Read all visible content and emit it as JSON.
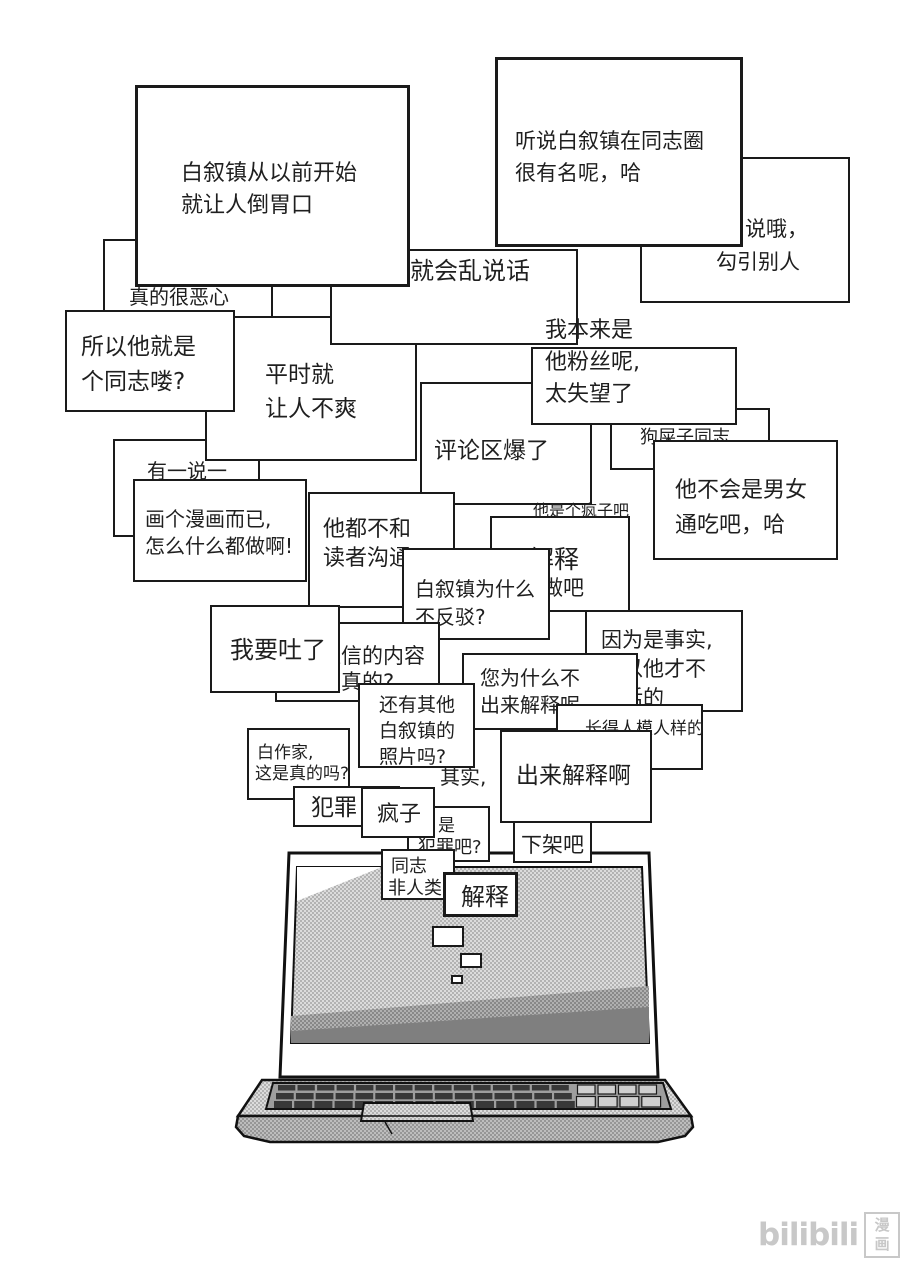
{
  "watermark": {
    "brand": "bilibili",
    "suffix": "漫画",
    "color": "#c8c8c8"
  },
  "palette": {
    "line": "#1a1a1a",
    "text": "#1f1f1f",
    "halftone_light": "#cccccc",
    "halftone_mid": "#a9a9a9",
    "wedge_dark": "#7f7f7f",
    "key_dark": "#383838",
    "key_light": "#cfcfcf"
  },
  "comments": [
    {
      "id": "comment-really-disgusting",
      "x": 103,
      "y": 239,
      "w": 170,
      "h": 92,
      "lines": [
        {
          "t": "真的很恶心",
          "dx": 24,
          "dy": 45,
          "s": 20
        }
      ]
    },
    {
      "id": "comment-to-be-fair",
      "x": 113,
      "y": 439,
      "w": 147,
      "h": 98,
      "lines": [
        {
          "t": "有一说一",
          "dx": 32,
          "dy": 19,
          "s": 20
        }
      ]
    },
    {
      "id": "comment-always-annoying",
      "x": 205,
      "y": 316,
      "w": 212,
      "h": 145,
      "lines": [
        {
          "t": "平时就",
          "dx": 58,
          "dy": 44,
          "s": 23
        },
        {
          "t": "让人不爽",
          "dx": 58,
          "dy": 78,
          "s": 23
        }
      ]
    },
    {
      "id": "comment-so-he-is-gay",
      "x": 65,
      "y": 310,
      "w": 170,
      "h": 102,
      "lines": [
        {
          "t": "所以他就是",
          "dx": 14,
          "dy": 22,
          "s": 23
        },
        {
          "t": "个同志喽?",
          "dx": 14,
          "dy": 57,
          "s": 23
        }
      ]
    },
    {
      "id": "comment-talks-nonsense",
      "x": 330,
      "y": 249,
      "w": 248,
      "h": 96,
      "lines": [
        {
          "t": "就会乱说话",
          "dx": 78,
          "dy": 7,
          "s": 24
        }
      ]
    },
    {
      "id": "comment-just-a-manga",
      "x": 133,
      "y": 479,
      "w": 174,
      "h": 103,
      "lines": [
        {
          "t": "画个漫画而已,",
          "dx": 10,
          "dy": 27,
          "s": 20
        },
        {
          "t": "怎么什么都做啊!",
          "dx": 10,
          "dy": 54,
          "s": 20
        }
      ]
    },
    {
      "id": "comment-disgusting-from-start",
      "x": 135,
      "y": 85,
      "w": 275,
      "h": 202,
      "bw": 3,
      "lines": [
        {
          "t": "白叙镇从以前开始",
          "dx": 43,
          "dy": 73,
          "s": 22
        },
        {
          "t": "就让人倒胃口",
          "dx": 43,
          "dy": 105,
          "s": 22
        }
      ]
    },
    {
      "id": "comment-seducing-others",
      "x": 640,
      "y": 157,
      "w": 210,
      "h": 146,
      "lines": [
        {
          "t": "说哦，",
          "dx": 103,
          "dy": 58,
          "s": 21
        },
        {
          "t": "勾引别人",
          "dx": 74,
          "dy": 91,
          "s": 21
        }
      ]
    },
    {
      "id": "comment-famous-in-gay-circle",
      "x": 495,
      "y": 57,
      "w": 248,
      "h": 190,
      "bw": 3,
      "lines": [
        {
          "t": "听说白叙镇在同志圈",
          "dx": 17,
          "dy": 69,
          "s": 21
        },
        {
          "t": "很有名呢，哈",
          "dx": 17,
          "dy": 101,
          "s": 21
        }
      ]
    },
    {
      "id": "comment-section-exploded",
      "x": 420,
      "y": 382,
      "w": 172,
      "h": 123,
      "lines": [
        {
          "t": "评论区爆了",
          "dx": 12,
          "dy": 54,
          "s": 23
        }
      ]
    },
    {
      "id": "comment-dogshit-comrade",
      "x": 610,
      "y": 408,
      "w": 160,
      "h": 62,
      "lines": [
        {
          "t": "狗屎子同志",
          "dx": 28,
          "dy": 18,
          "s": 18
        }
      ]
    },
    {
      "id": "comment-was-his-fan",
      "x": 531,
      "y": 347,
      "w": 206,
      "h": 78,
      "lines": [
        {
          "t": "我本来是",
          "dx": 12,
          "dy": -31,
          "s": 22
        },
        {
          "t": "他粉丝呢,",
          "dx": 12,
          "dy": 1,
          "s": 22
        },
        {
          "t": "太失望了",
          "dx": 12,
          "dy": 33,
          "s": 22
        }
      ]
    },
    {
      "id": "comment-swings-both-ways",
      "x": 653,
      "y": 440,
      "w": 185,
      "h": 120,
      "lines": [
        {
          "t": "他不会是男女",
          "dx": 20,
          "dy": 36,
          "s": 22
        },
        {
          "t": "通吃吧，哈",
          "dx": 20,
          "dy": 71,
          "s": 22
        }
      ]
    },
    {
      "id": "comment-never-talks-to-readers",
      "x": 308,
      "y": 492,
      "w": 147,
      "h": 116,
      "lines": [
        {
          "t": "他都不和",
          "dx": 13,
          "dy": 23,
          "s": 22
        },
        {
          "t": "读者沟通",
          "dx": 13,
          "dy": 52,
          "s": 22
        }
      ]
    },
    {
      "id": "comment-explain-do-it",
      "x": 490,
      "y": 516,
      "w": 140,
      "h": 96,
      "lines": [
        {
          "t": "解释",
          "dx": 37,
          "dy": 28,
          "s": 25
        },
        {
          "t": "做吧",
          "dx": 50,
          "dy": 58,
          "s": 21
        }
      ]
    },
    {
      "id": "comment-why-not-refute",
      "x": 402,
      "y": 548,
      "w": 148,
      "h": 92,
      "lines": [
        {
          "t": "白叙镇为什么",
          "dx": 11,
          "dy": 28,
          "s": 20
        },
        {
          "t": "不反驳?",
          "dx": 11,
          "dy": 56,
          "s": 20
        }
      ]
    },
    {
      "id": "comment-are-texts-real",
      "x": 275,
      "y": 622,
      "w": 165,
      "h": 80,
      "lines": [
        {
          "t": "短信的内容",
          "dx": 43,
          "dy": 20,
          "s": 21
        },
        {
          "t": "是真的?",
          "dx": 43,
          "dy": 46,
          "s": 21
        }
      ]
    },
    {
      "id": "comment-gonna-puke",
      "x": 210,
      "y": 605,
      "w": 130,
      "h": 88,
      "lines": [
        {
          "t": "我要吐了",
          "dx": 18,
          "dy": 30,
          "s": 24
        }
      ]
    },
    {
      "id": "comment-because-its-true",
      "x": 585,
      "y": 610,
      "w": 158,
      "h": 102,
      "lines": [
        {
          "t": "因为是事实,",
          "dx": 14,
          "dy": 16,
          "s": 21
        },
        {
          "t": "所以他才不",
          "dx": 14,
          "dy": 45,
          "s": 21
        },
        {
          "t": "说话的",
          "dx": 14,
          "dy": 74,
          "s": 21
        }
      ]
    },
    {
      "id": "comment-why-no-explanation",
      "x": 462,
      "y": 653,
      "w": 176,
      "h": 77,
      "lines": [
        {
          "t": "您为什么不",
          "dx": 16,
          "dy": 12,
          "s": 20
        },
        {
          "t": "出来解释呢",
          "dx": 16,
          "dy": 39,
          "s": 20
        }
      ]
    },
    {
      "id": "comment-looks-decent",
      "x": 556,
      "y": 704,
      "w": 147,
      "h": 66,
      "lines": [
        {
          "t": "长得人模人样的",
          "dx": 27,
          "dy": 14,
          "s": 17
        }
      ]
    },
    {
      "id": "comment-other-photos",
      "x": 358,
      "y": 683,
      "w": 117,
      "h": 85,
      "lines": [
        {
          "t": "还有其他",
          "dx": 19,
          "dy": 10,
          "s": 19
        },
        {
          "t": "白叙镇的",
          "dx": 19,
          "dy": 36,
          "s": 19
        },
        {
          "t": "照片吗?",
          "dx": 19,
          "dy": 62,
          "s": 19
        }
      ]
    },
    {
      "id": "comment-come-out-explain",
      "x": 500,
      "y": 730,
      "w": 152,
      "h": 93,
      "lines": [
        {
          "t": "出来解释啊",
          "dx": 14,
          "dy": 31,
          "s": 23
        }
      ]
    },
    {
      "id": "comment-author-bai-true",
      "x": 247,
      "y": 728,
      "w": 103,
      "h": 72,
      "lines": [
        {
          "t": "白作家,",
          "dx": 8,
          "dy": 14,
          "s": 17
        },
        {
          "t": "这是真的吗?",
          "dx": 6,
          "dy": 35,
          "s": 17
        }
      ]
    },
    {
      "id": "comment-crime",
      "x": 293,
      "y": 786,
      "w": 107,
      "h": 41,
      "lines": [
        {
          "t": "犯罪",
          "dx": 16,
          "dy": 7,
          "s": 23
        }
      ]
    },
    {
      "id": "comment-is-a-crime",
      "x": 407,
      "y": 806,
      "w": 83,
      "h": 56,
      "lines": [
        {
          "t": "是",
          "dx": 29,
          "dy": 9,
          "s": 17
        },
        {
          "t": "犯罪吧?",
          "dx": 9,
          "dy": 30,
          "s": 18
        }
      ]
    },
    {
      "id": "comment-madman",
      "x": 361,
      "y": 787,
      "w": 74,
      "h": 51,
      "lines": [
        {
          "t": "疯子",
          "dx": 14,
          "dy": 13,
          "s": 22
        }
      ]
    },
    {
      "id": "comment-take-it-down",
      "x": 513,
      "y": 821,
      "w": 79,
      "h": 42,
      "lines": [
        {
          "t": "下架吧",
          "dx": 6,
          "dy": 10,
          "s": 21
        }
      ]
    },
    {
      "id": "comment-gay-not-human",
      "x": 381,
      "y": 849,
      "w": 74,
      "h": 51,
      "lines": [
        {
          "t": "同志",
          "dx": 8,
          "dy": 6,
          "s": 18
        },
        {
          "t": "非人类",
          "dx": 5,
          "dy": 28,
          "s": 18
        }
      ]
    },
    {
      "id": "comment-explain",
      "x": 443,
      "y": 872,
      "w": 75,
      "h": 45,
      "bw": 3,
      "lines": [
        {
          "t": "解释",
          "dx": 15,
          "dy": 9,
          "s": 24
        }
      ]
    },
    {
      "id": "mini-comment-1",
      "x": 432,
      "y": 926,
      "w": 32,
      "h": 21,
      "lines": []
    },
    {
      "id": "mini-comment-2",
      "x": 460,
      "y": 953,
      "w": 22,
      "h": 15,
      "lines": []
    },
    {
      "id": "mini-comment-3",
      "x": 451,
      "y": 975,
      "w": 12,
      "h": 9,
      "lines": []
    }
  ],
  "floating_texts": [
    {
      "id": "comment-he-is-crazy",
      "t": "他是个疯子吧",
      "x": 533,
      "y": 502,
      "s": 16
    },
    {
      "id": "comment-actually",
      "t": "其实,",
      "x": 440,
      "y": 766,
      "s": 20
    }
  ],
  "laptop": {
    "keyboard": {
      "left_rows": 3,
      "left_cols": 15,
      "right_rows": 2,
      "right_cols": 4
    }
  }
}
